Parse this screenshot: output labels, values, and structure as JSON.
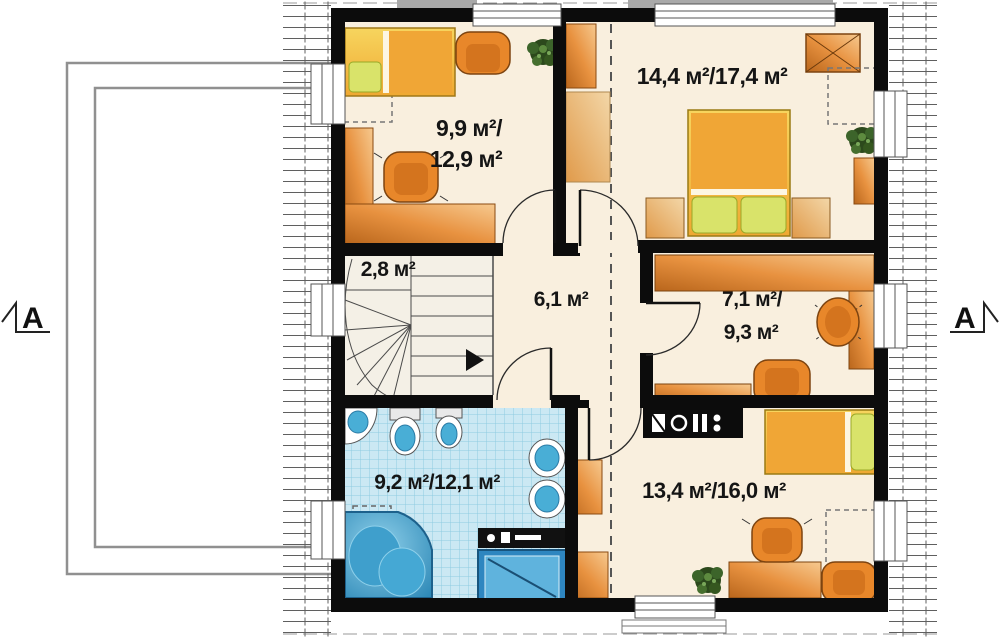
{
  "plan": {
    "section_markers": {
      "left": "A",
      "right": "A"
    },
    "rooms": [
      {
        "name": "bedroom-top-left",
        "area_line1": "9,9 м²/",
        "area_line2": "12,9 м²"
      },
      {
        "name": "bedroom-top-right",
        "area": "14,4 м²/17,4 м²"
      },
      {
        "name": "stair-landing",
        "area": "2,8 м²"
      },
      {
        "name": "hallway",
        "area": "6,1 м²"
      },
      {
        "name": "study",
        "area_line1": "7,1 м²/",
        "area_line2": "9,3 м²"
      },
      {
        "name": "bathroom",
        "area": "9,2 м²/12,1 м²"
      },
      {
        "name": "bedroom-bottom-right",
        "area": "13,4 м²/16,0 м²"
      }
    ],
    "colors": {
      "wall": "#0c0c0c",
      "floor": "#f9efde",
      "furniture_orange": "#e8872a",
      "bed_yellow": "#f2c24a",
      "pillow_green": "#d9e36a",
      "bathroom_tile": "#cbe8f3",
      "fixture_blue": "#49aed6",
      "label_text": "#151515"
    }
  }
}
